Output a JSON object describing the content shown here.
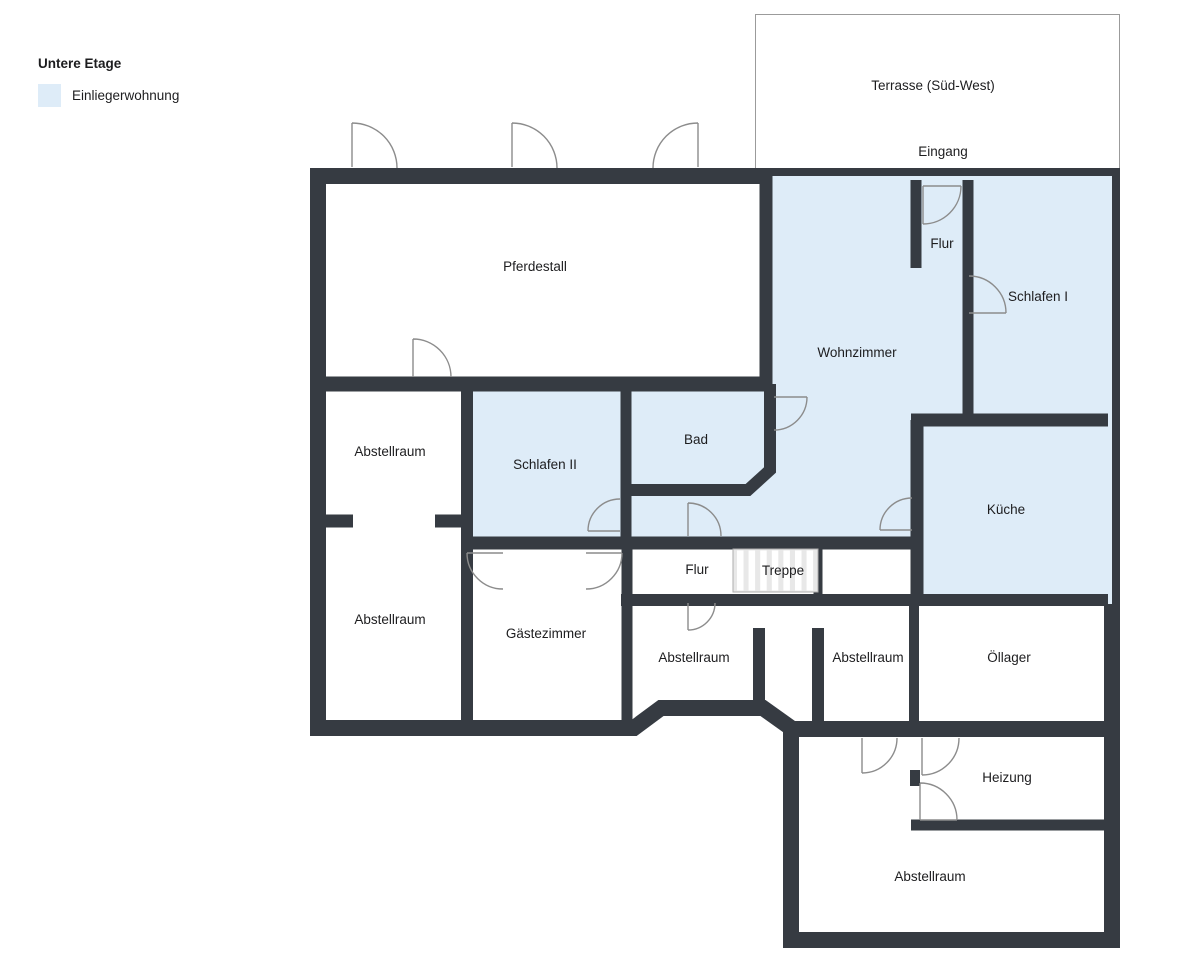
{
  "legend": {
    "title": "Untere Etage",
    "items": [
      {
        "label": "Einliegerwohnung",
        "color": "#DEECF8"
      }
    ]
  },
  "outdoor": {
    "terrace_label": "Terrasse (Süd-West)",
    "entrance_label": "Eingang"
  },
  "rooms": {
    "pferdestall": "Pferdestall",
    "flur_oben": "Flur",
    "schlafen1": "Schlafen I",
    "wohnzimmer": "Wohnzimmer",
    "abstellraum_links_oben": "Abstellraum",
    "schlafen2": "Schlafen II",
    "bad": "Bad",
    "kueche": "Küche",
    "abstellraum_links_unten": "Abstellraum",
    "gaestezimmer": "Gästezimmer",
    "flur_unten": "Flur",
    "treppe": "Treppe",
    "abstellraum_mitte": "Abstellraum",
    "abstellraum_rechts": "Abstellraum",
    "oellager": "Öllager",
    "heizung": "Heizung",
    "abstellraum_sued": "Abstellraum"
  },
  "colors": {
    "wall": "#363B42",
    "apartment_fill": "#DEECF8",
    "door_stroke": "#8C8C8C"
  }
}
